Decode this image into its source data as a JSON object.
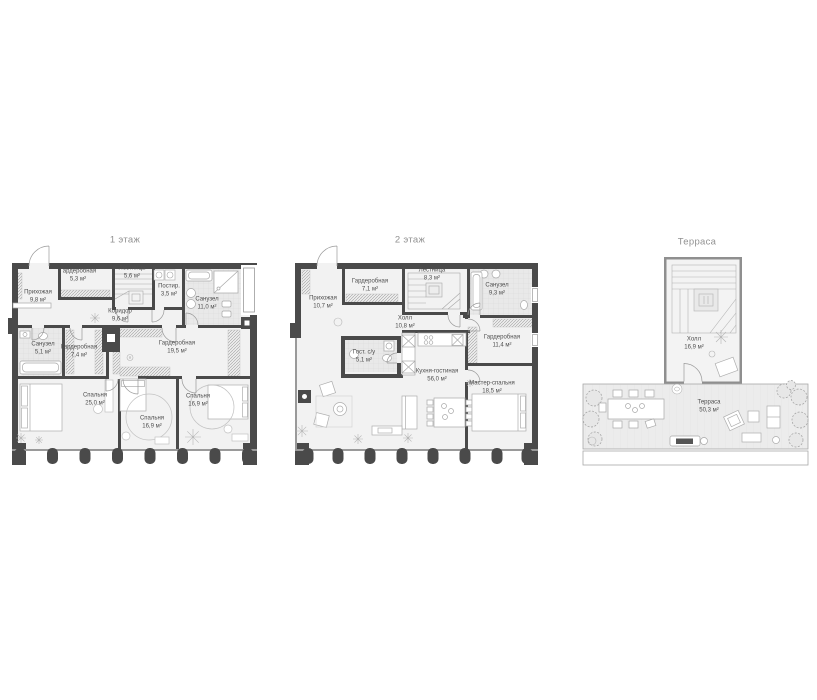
{
  "document": {
    "type": "floor-plan-sheet",
    "background": "#ffffff"
  },
  "colors": {
    "wall": "#4a4a4a",
    "floor": "#f2f2f2",
    "tile": "#e9e9e9",
    "deck": "#ececec",
    "furniture_line": "#adadad",
    "title_text": "#919191",
    "label_text": "#4e4e4e"
  },
  "plans": [
    {
      "title": "1 этаж",
      "rooms": [
        {
          "name": "Прихожая",
          "area": "9,8 м²"
        },
        {
          "name": "Гардеробная",
          "area": "5,3 м²"
        },
        {
          "name": "Лестница",
          "area": "5,6 м²"
        },
        {
          "name": "Постир.",
          "area": "3,5 м²"
        },
        {
          "name": "Санузел",
          "area": "11,0 м²"
        },
        {
          "name": "Коридор",
          "area": "9,6 м²"
        },
        {
          "name": "Санузел",
          "area": "5,1 м²"
        },
        {
          "name": "Гардеробная",
          "area": "7,4 м²"
        },
        {
          "name": "Гардеробная",
          "area": "19,5 м²"
        },
        {
          "name": "Спальня",
          "area": "25,0 м²"
        },
        {
          "name": "Спальня",
          "area": "16,9 м²"
        },
        {
          "name": "Спальня",
          "area": "16,9 м²"
        }
      ]
    },
    {
      "title": "2 этаж",
      "rooms": [
        {
          "name": "Прихожая",
          "area": "10,7 м²"
        },
        {
          "name": "Гардеробная",
          "area": "7,1 м²"
        },
        {
          "name": "Лестница",
          "area": "8,3 м²"
        },
        {
          "name": "Санузел",
          "area": "9,3 м²"
        },
        {
          "name": "Холл",
          "area": "10,8 м²"
        },
        {
          "name": "Гост. с/у",
          "area": "5,1 м²"
        },
        {
          "name": "Гардеробная",
          "area": "11,4 м²"
        },
        {
          "name": "Кухня-гостиная",
          "area": "56,0 м²"
        },
        {
          "name": "Мастер-спальня",
          "area": "18,5 м²"
        }
      ]
    },
    {
      "title": "Терраса",
      "rooms": [
        {
          "name": "Холл",
          "area": "16,9 м²"
        },
        {
          "name": "Терраса",
          "area": "50,3 м²"
        }
      ]
    }
  ]
}
